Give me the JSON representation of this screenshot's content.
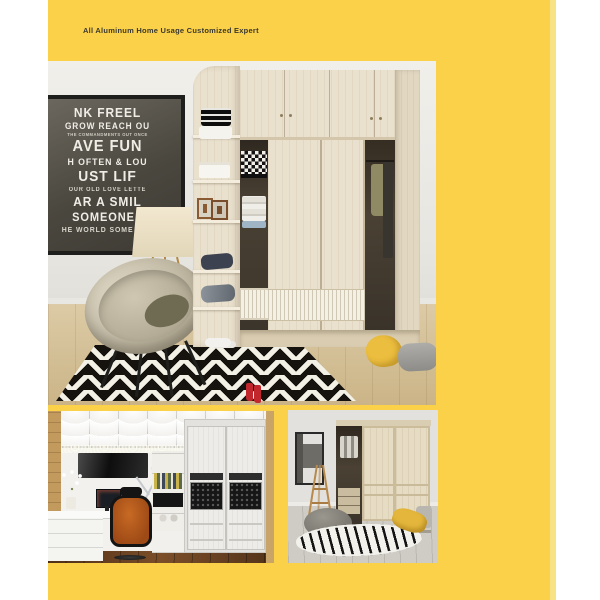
{
  "header": {
    "tagline": "All Aluminum Home Usage Customized Expert"
  },
  "colors": {
    "page_background": "#FFFFFF",
    "panel_yellow": "#FBD149",
    "panel_edge_highlight": "#F7E386",
    "tagline_text": "#3A382F",
    "accent_red_boots": "#C1272D",
    "accent_orange_chair": "#B85C1F",
    "accent_yellow_blanket": "#ECBE3F",
    "wardrobe_wood": "#E9E0CD"
  },
  "photos": {
    "main": {
      "description": "showroom with maple wardrobe, corner shelves, wall poster, tripod lamp, wicker saucer chair and chevron rug",
      "poster": {
        "lines": [
          "NK FREEL",
          "GROW REACH OU",
          "THE COMMANDMENTS OUT ONCE",
          "AVE FUN",
          "H OFTEN & LOU",
          "UST LIF",
          "OUR OLD LOVE LETTE",
          "AR A SMIL",
          "SOMEONE I",
          "HE WORLD SOME LOV"
        ]
      }
    },
    "study": {
      "description": "study room with white cabinets, desk, orange office chair and mesh-panel sliding wardrobe"
    },
    "sliding": {
      "description": "bedroom corner with two-door sliding wardrobe, ladder rack, pouf and zebra rug"
    }
  }
}
